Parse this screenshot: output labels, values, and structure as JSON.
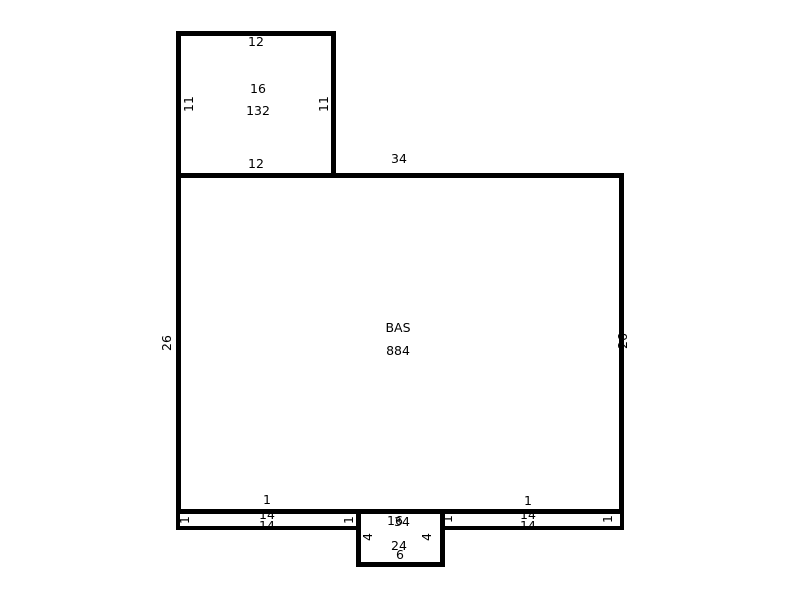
{
  "diagram": {
    "type": "floor-plan-sketch",
    "background": "#ffffff",
    "wall_color": "#000000",
    "text_color": "#000000",
    "areas": {
      "addition": {
        "code": "16",
        "area": "132",
        "dims": {
          "top": "12",
          "bottom": "12",
          "left": "11",
          "right": "11"
        }
      },
      "base": {
        "code": "BAS",
        "area": "884",
        "dims": {
          "top": "34",
          "bottom": "34",
          "left": "26",
          "right": "26"
        }
      },
      "left_strip": {
        "label": "1",
        "dims": {
          "top": "14",
          "bottom": "14",
          "left": "1",
          "right": "1"
        }
      },
      "right_strip": {
        "label": "1",
        "dims": {
          "top": "14",
          "bottom": "14",
          "left": "1",
          "right": "1"
        }
      },
      "stoop": {
        "code": "16",
        "area": "24",
        "dims": {
          "bottom": "6",
          "left": "4",
          "right": "4"
        }
      }
    }
  }
}
